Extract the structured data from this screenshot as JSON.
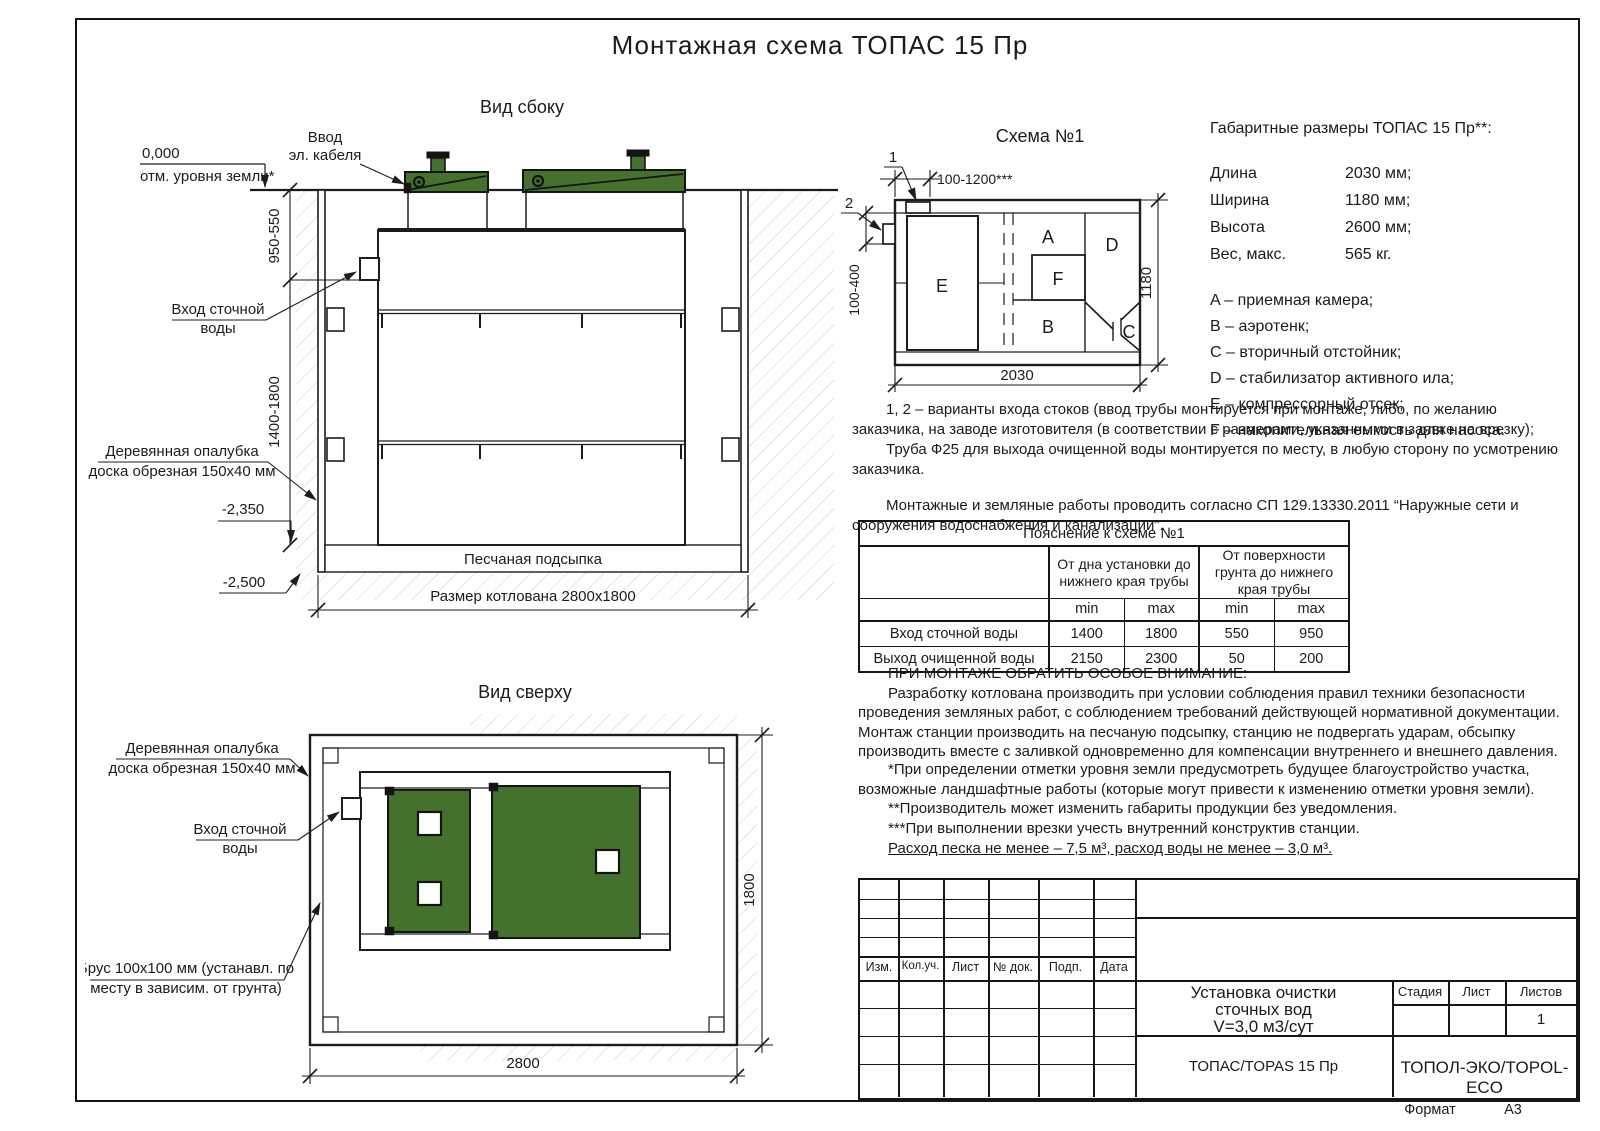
{
  "colors": {
    "green": "#44712e",
    "line": "#1c1c1c"
  },
  "page": {
    "title": "Монтажная схема ТОПАС 15 Пр",
    "format_label": "Формат",
    "format_value": "А3"
  },
  "side": {
    "title": "Вид сбоку",
    "zero": "0,000",
    "ground": "отм. уровня земли*",
    "cable1": "Ввод",
    "cable2": "эл. кабеля",
    "dim_upper": "950-550",
    "dim_lower": "1400-1800",
    "inlet1": "Вход сточной",
    "inlet2": "воды",
    "formwork1": "Деревянная опалубка",
    "formwork2": "доска обрезная 150х40 мм",
    "level_mid": "-2,350",
    "level_bottom": "-2,500",
    "sand": "Песчаная подсыпка",
    "pit_size": "Размер котлована 2800х1800"
  },
  "scheme": {
    "title": "Схема №1",
    "c1": "1",
    "c2": "2",
    "dim_top": "100-1200***",
    "dim_left": "100-400",
    "dim_width": "1180",
    "dim_length": "2030",
    "comp_a": "A",
    "comp_b": "B",
    "comp_c": "C",
    "comp_d": "D",
    "comp_e": "E",
    "comp_f": "F"
  },
  "specs": {
    "title": "Габаритные размеры ТОПАС 15 Пр**:",
    "rows": [
      {
        "label": "Длина",
        "value": "2030 мм;"
      },
      {
        "label": "Ширина",
        "value": "1180 мм;"
      },
      {
        "label": "Высота",
        "value": "2600 мм;"
      },
      {
        "label": "Вес, макс.",
        "value": "565 кг."
      }
    ]
  },
  "legend": {
    "items": [
      "A – приемная камера;",
      "B – аэротенк;",
      "C – вторичный отстойник;",
      "D – стабилизатор активного ила;",
      "E – компрессорный отсек;",
      "F – накопительная емкость для насоса."
    ]
  },
  "notes": {
    "p1": "1, 2 – варианты входа стоков (ввод трубы монтируется при монтаже, либо, по желанию заказчика, на заводе изготовителя (в соответствии с размерами, указанными в заявке на врезку);",
    "p2": "Труба Ф25 для выхода очищенной воды монтируется по месту, в любую сторону по усмотрению заказчика.",
    "p3": "Монтажные и земляные работы проводить согласно СП 129.13330.2011 “Наружные сети и сооружения водоснабжения и канализации”."
  },
  "tbl": {
    "caption": "Пояснение к схеме №1",
    "group1": "От дна установки до нижнего края трубы",
    "group2": "От поверхности грунта до нижнего края трубы",
    "min": "min",
    "max": "max",
    "rows": [
      {
        "label": "Вход сточной воды",
        "c1": "1400",
        "c2": "1800",
        "c3": "550",
        "c4": "950"
      },
      {
        "label": "Выход очищенной воды",
        "c1": "2150",
        "c2": "2300",
        "c3": "50",
        "c4": "200"
      }
    ]
  },
  "attention": {
    "title": "ПРИ МОНТАЖЕ ОБРАТИТЬ ОСОБОЕ ВНИМАНИЕ:",
    "body": "Разработку котлована производить при условии соблюдения правил техники безопасности проведения земляных работ, с соблюдением требований действующей нормативной документации. Монтаж станции производить на песчаную подсыпку, станцию не подвергать ударам, обсыпку производить вместе с заливкой одновременно для компенсации внутреннего и внешнего давления."
  },
  "footnotes": [
    "*При определении отметки уровня земли предусмотреть будущее благоустройство участка, возможные ландшафтные работы (которые могут привести к изменению отметки уровня земли).",
    "**Производитель может изменить габариты продукции без уведомления.",
    "***При выполнении врезки учесть внутренний конструктив станции."
  ],
  "consumption": {
    "text": "Расход песка не менее – 7,5 м³, расход воды не менее – 3,0 м³."
  },
  "top": {
    "title": "Вид сверху",
    "formwork1": "Деревянная опалубка",
    "formwork2": "доска обрезная 150х40 мм",
    "inlet1": "Вход сточной",
    "inlet2": "воды",
    "brus1": "Брус 100х100 мм (устанавл. по",
    "brus2": "месту в зависим. от грунта)",
    "dim_width": "1800",
    "dim_length": "2800"
  },
  "tb": {
    "rev": [
      "Изм.",
      "Кол.уч.",
      "Лист",
      "№ док.",
      "Подп.",
      "Дата"
    ],
    "doc1": "Установка очистки",
    "doc2": "сточных вод",
    "doc3": "V=3,0 м3/сут",
    "stage": "Стадия",
    "sheet": "Лист",
    "sheets": "Листов",
    "sheets_value": "1",
    "model": "ТОПАС/TOPAS 15 Пр",
    "brand": "ТОПОЛ-ЭКО/TOPOL-ECO"
  }
}
